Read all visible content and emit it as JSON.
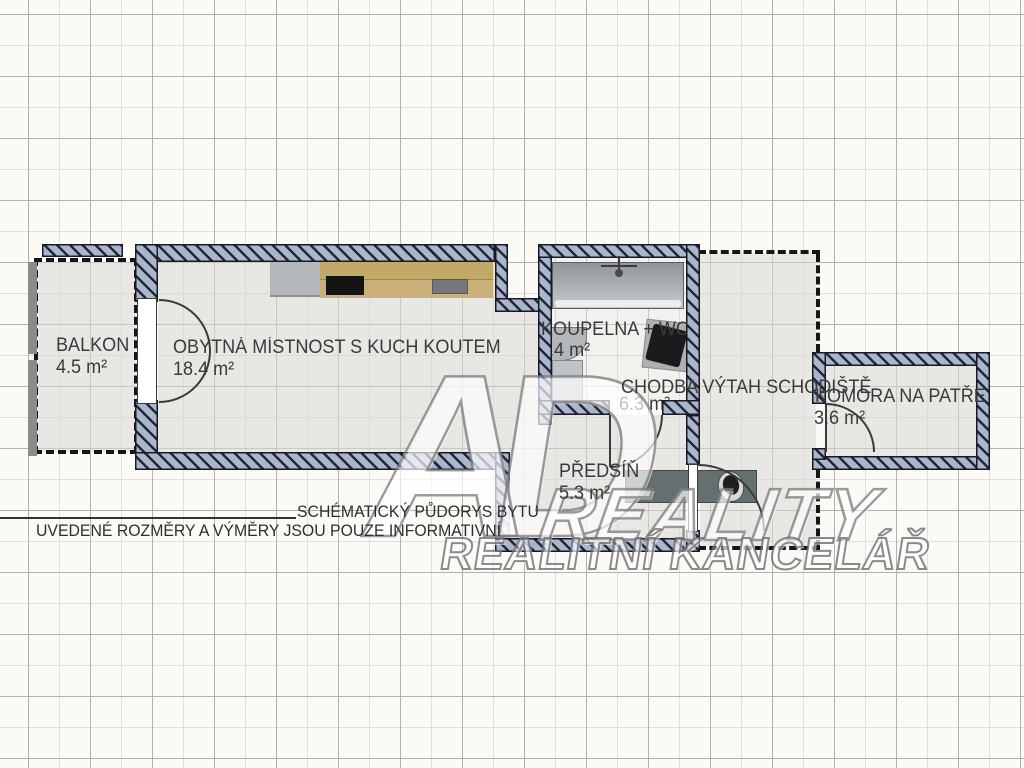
{
  "rooms": {
    "balkon": {
      "label": "BALKON",
      "area": "4.5 m²"
    },
    "obytna": {
      "label": "OBYTNÁ MÍSTNOST S KUCH KOUTEM",
      "area": "18.4 m²"
    },
    "koupelna": {
      "label": "KOUPELNA + WC",
      "area": "3.4 m²"
    },
    "chodba": {
      "label": "CHODBA VÝTAH SCHODIŠTĚ",
      "area": "6.3 m²"
    },
    "predsin": {
      "label": "PŘEDSÍŇ",
      "area": "5.3 m²"
    },
    "komora": {
      "label": "KOMORA NA PATŘE",
      "area": "3.6 m²"
    }
  },
  "notes": {
    "schematic": "SCHÉMATICKÝ PŮDORYS BYTU",
    "disclaimer": "UVEDENÉ ROZMĚRY A VÝMĚRY JSOU POUZE INFORMATIVNÍ"
  },
  "watermark": {
    "logo": "AD",
    "line1": "REALITY",
    "line2": "REALITNÍ KANCELÁŘ"
  },
  "colors": {
    "wall_fill": "#a9b7cd",
    "wall_hatch": "#26263a",
    "floor": "#e8e7e4",
    "bathroom_floor": "#f2f1ee",
    "counter_wood": "#c3a968",
    "hall_cabinet": "#64706f"
  }
}
